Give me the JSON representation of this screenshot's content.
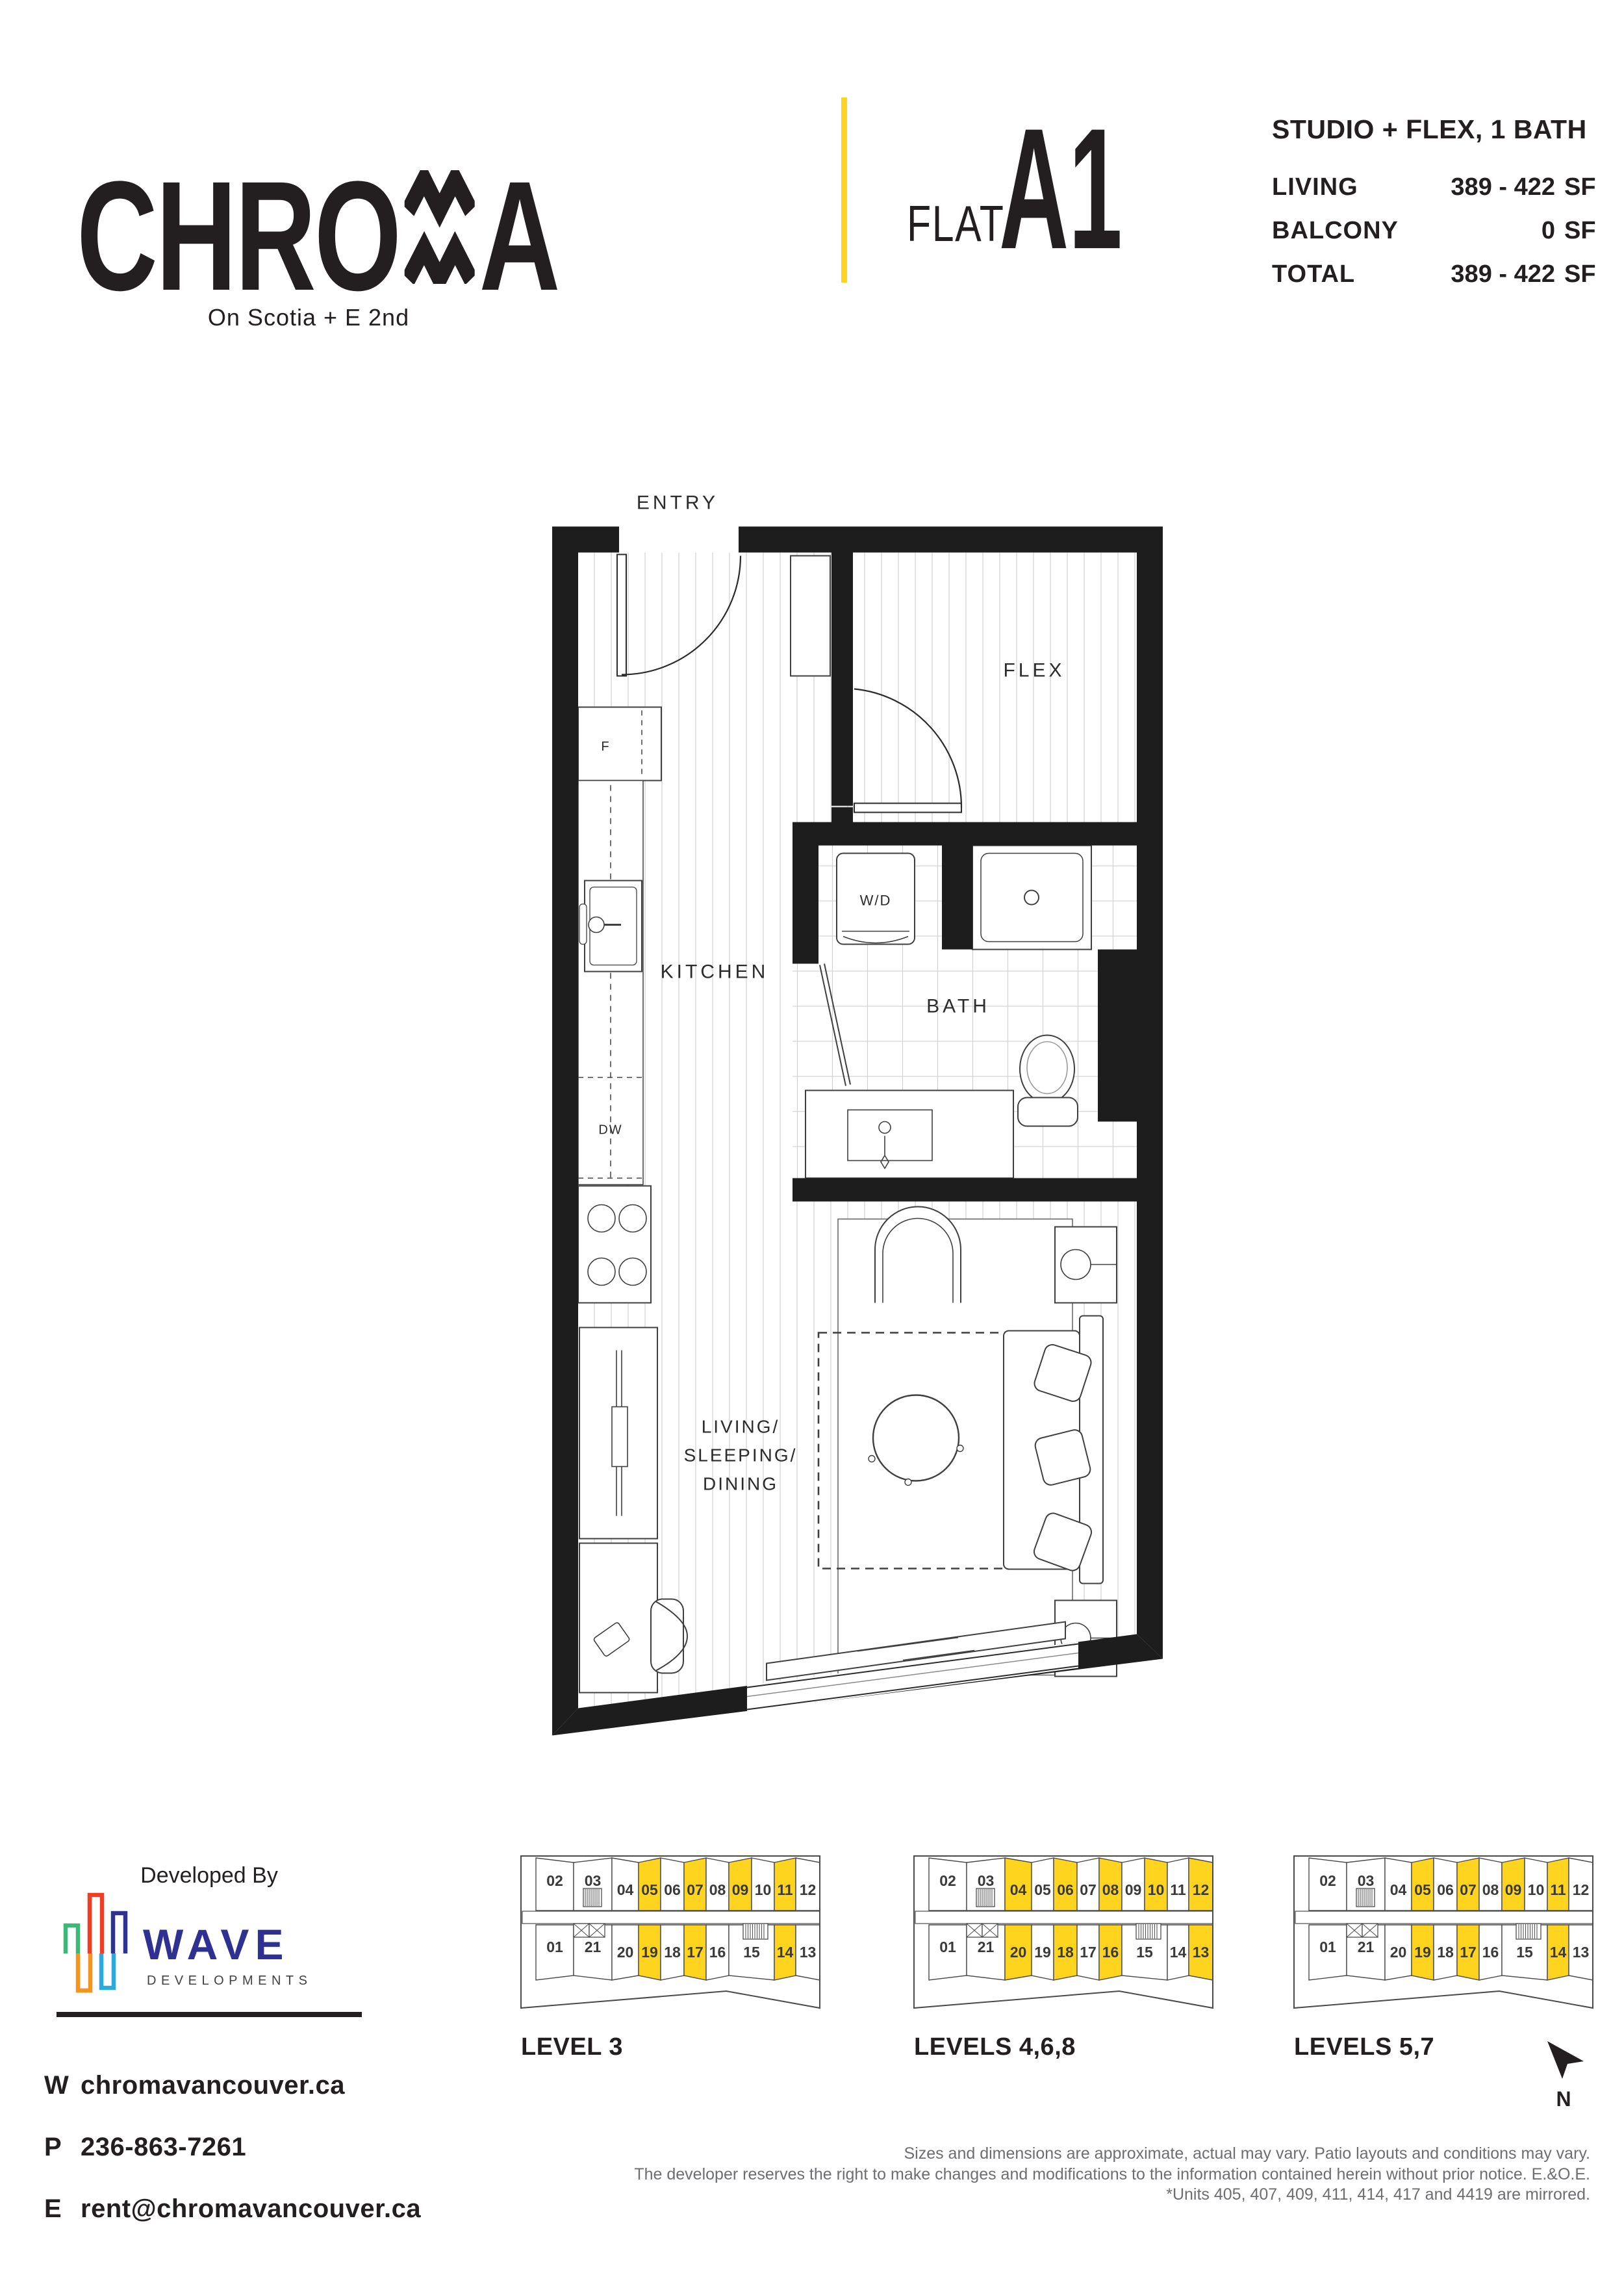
{
  "brand": {
    "name": "CHROMA",
    "name_pre": "CHRO",
    "name_post": "A",
    "tagline": "On Scotia + E 2nd"
  },
  "unit": {
    "flat_label": "FLAT",
    "flat_code": "A1",
    "type": "STUDIO + FLEX, 1 BATH",
    "specs": [
      {
        "label": "LIVING",
        "value": "389 - 422",
        "unit": "SF"
      },
      {
        "label": "BALCONY",
        "value": "0",
        "unit": "SF"
      },
      {
        "label": "TOTAL",
        "value": "389 - 422",
        "unit": "SF"
      }
    ]
  },
  "floorplan": {
    "rooms": {
      "entry": "ENTRY",
      "flex": "FLEX",
      "kitchen": "KITCHEN",
      "bath": "BATH",
      "living_lines": [
        "LIVING/",
        "SLEEPING/",
        "DINING"
      ],
      "washer_dryer": "W/D",
      "fridge": "F",
      "dishwasher": "DW"
    }
  },
  "developer": {
    "heading": "Developed By",
    "name": "WAVE",
    "subtitle": "DEVELOPMENTS"
  },
  "contact": {
    "website": {
      "label": "W",
      "value": "chromavancouver.ca"
    },
    "phone": {
      "label": "P",
      "value": "236-863-7261"
    },
    "email": {
      "label": "E",
      "value": "rent@chromavancouver.ca"
    }
  },
  "levels": {
    "top_row": [
      "02",
      "03",
      "04",
      "05",
      "06",
      "07",
      "08",
      "09",
      "10",
      "11",
      "12"
    ],
    "bottom_row": [
      "01",
      "21",
      "20",
      "19",
      "18",
      "17",
      "16",
      "15",
      "14",
      "13"
    ],
    "items": [
      {
        "label": "LEVEL 3",
        "highlighted": [
          "05",
          "07",
          "09",
          "11",
          "19",
          "17",
          "14"
        ]
      },
      {
        "label": "LEVELS 4,6,8",
        "highlighted": [
          "04",
          "06",
          "08",
          "10",
          "12",
          "20",
          "18",
          "16",
          "13"
        ]
      },
      {
        "label": "LEVELS 5,7",
        "highlighted": [
          "05",
          "07",
          "09",
          "11",
          "19",
          "17",
          "14"
        ]
      }
    ],
    "highlight_color": "#FFD41E"
  },
  "compass": {
    "label": "N"
  },
  "disclaimer": {
    "lines": [
      "Sizes and dimensions are approximate, actual may vary. Patio layouts and conditions may vary.",
      "The developer reserves the right to make changes and modifications to the information contained herein without prior notice. E.&O.E.",
      "*Units 405, 407, 409, 411, 414, 417 and 4419 are mirrored."
    ]
  },
  "colors": {
    "accent_yellow": "#FFD41E",
    "ink": "#231F20",
    "wave_navy": "#2E3192",
    "logo_green": "#3CB878",
    "logo_red": "#EF3E23",
    "logo_orange": "#F7941E",
    "logo_light_blue": "#29ABE2",
    "gray_text": "#6D6E71"
  }
}
